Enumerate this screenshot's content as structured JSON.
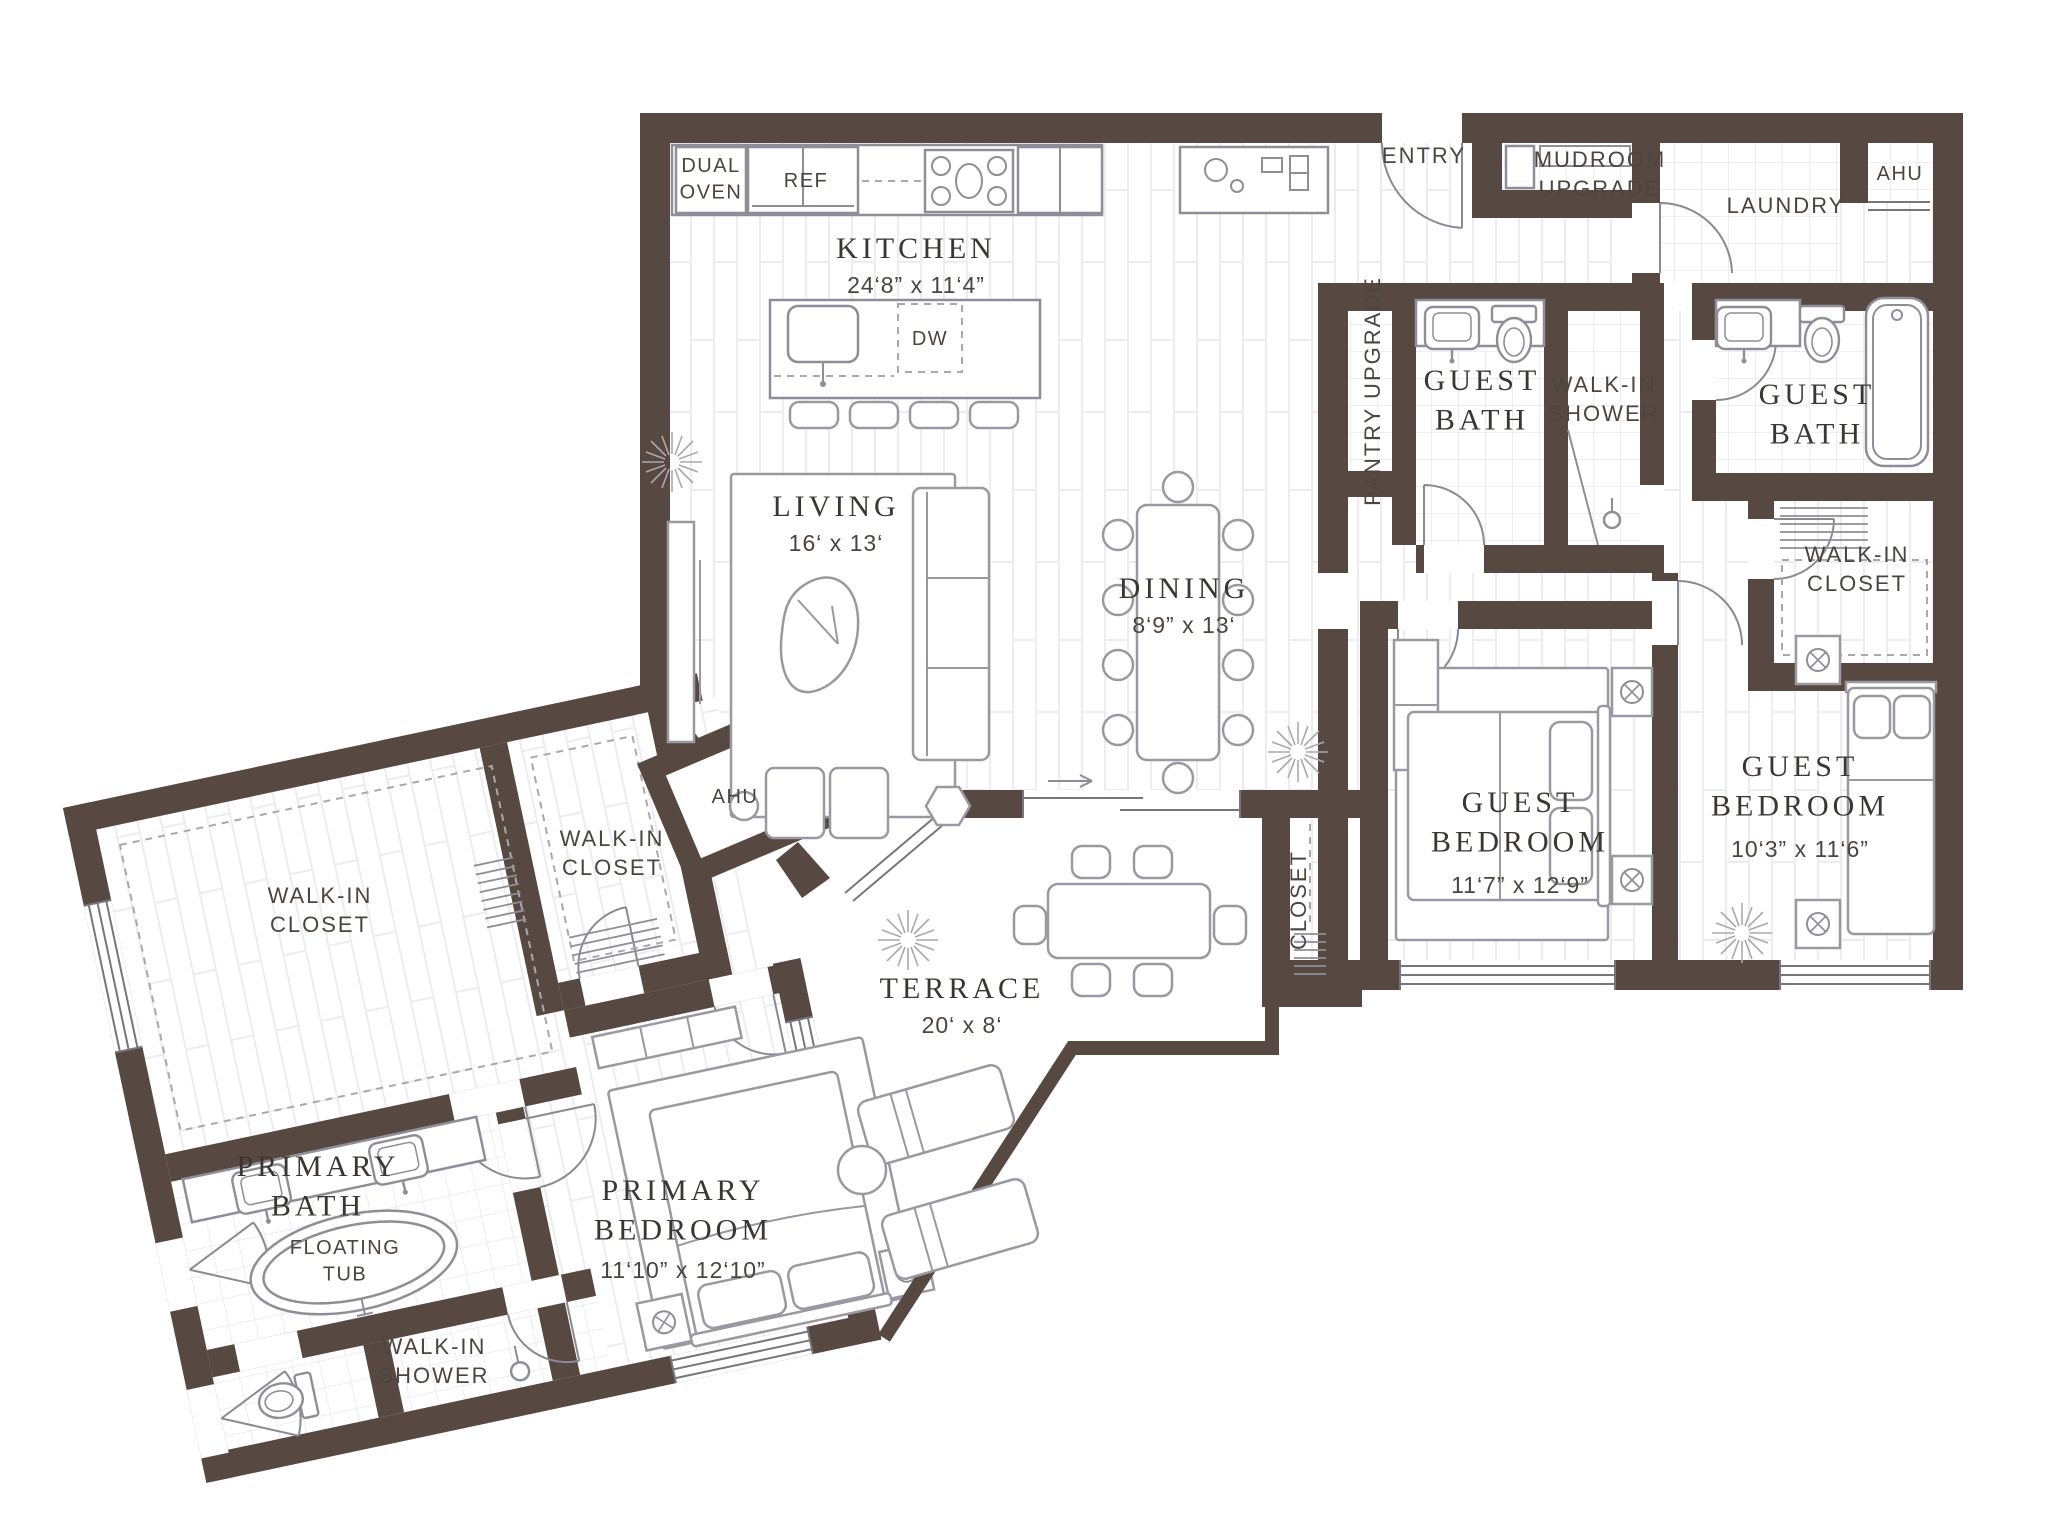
{
  "colors": {
    "wall": "#574941",
    "line": "#9a99a2",
    "fixture": "#8f8e98",
    "text": "#3c3633",
    "text_sans": "#4b443f"
  },
  "rooms": {
    "kitchen": {
      "name": "KITCHEN",
      "dims": "24‘8” x 11‘4”"
    },
    "living": {
      "name": "LIVING",
      "dims": "16‘ x 13‘"
    },
    "dining": {
      "name": "DINING",
      "dims": "8‘9” x 13‘"
    },
    "terrace": {
      "name": "TERRACE",
      "dims": "20‘ x 8‘"
    },
    "entry": {
      "name": "ENTRY"
    },
    "mudroom": {
      "name": "MUDROOM\nUPGRADE"
    },
    "laundry": {
      "name": "LAUNDRY"
    },
    "ahu_entry": {
      "name": "AHU"
    },
    "ahu_suite": {
      "name": "AHU"
    },
    "pantry": {
      "name": "PANTRY UPGRADE"
    },
    "closet_hall": {
      "name": "CLOSET"
    },
    "guest_bath_1": {
      "name": "GUEST\nBATH"
    },
    "guest_bath_2": {
      "name": "GUEST\nBATH"
    },
    "walk_in_shower_guest": {
      "name": "WALK-IN\nSHOWER"
    },
    "walk_in_closet_guest": {
      "name": "WALK-IN\nCLOSET"
    },
    "guest_bedroom_1": {
      "name": "GUEST\nBEDROOM",
      "dims": "11‘7” x 12‘9”"
    },
    "guest_bedroom_2": {
      "name": "GUEST\nBEDROOM",
      "dims": "10‘3” x 11‘6”"
    },
    "walk_in_closet_primary": {
      "name": "WALK-IN\nCLOSET"
    },
    "walk_in_closet_primary_2": {
      "name": "WALK-IN\nCLOSET"
    },
    "primary_bath": {
      "name": "PRIMARY\nBATH"
    },
    "floating_tub": {
      "name": "FLOATING\nTUB"
    },
    "walk_in_shower_primary": {
      "name": "WALK-IN\nSHOWER"
    },
    "primary_bedroom": {
      "name": "PRIMARY\nBEDROOM",
      "dims": "11‘10” x 12‘10”"
    }
  },
  "appliances": {
    "dual_oven": "DUAL\nOVEN",
    "ref": "REF",
    "dw": "DW"
  }
}
